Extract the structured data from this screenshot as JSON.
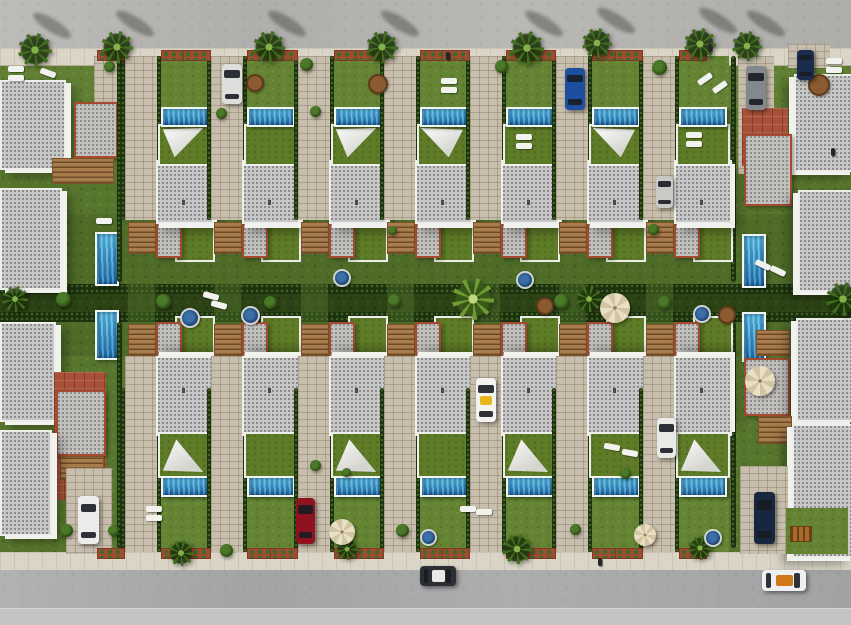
{
  "scene": {
    "kind": "3d-aerial-render",
    "width": 851,
    "height": 625,
    "description": "Top-down aerial 3D render of a residential development: two facing rows of seven detached villas with private pools, white shade sails, gardens and paved driveways, flanked by larger corner buildings, bounded by palm-lined roads at top and bottom with parked cars."
  },
  "palette": {
    "grass": "#57762d",
    "lawn_light": "#648434",
    "alley_green": "#2c4415",
    "hedge": "#1c310e",
    "road": "#b5b4b1",
    "road_bottom": "#a9a9ab",
    "road_bottom_light": "#c4c3c5",
    "sidewalk": "#dad5c6",
    "paver": "#c8bead",
    "terracotta": "#a85138",
    "roof_gray": "#c7c7c7",
    "roof_trim_white": "#ededea",
    "roof_trim_red": "#a34a31",
    "green_roof": "#5e7c27",
    "pool_water": "#2a93cc",
    "pool_coping": "#f0f5f4",
    "sail_white": "#f4f4f1",
    "wood": "#a87c4c",
    "planter_red": "#a04b33",
    "umbrella_beige": "#e0d5b4"
  },
  "layout": {
    "road_top": {
      "x": 0,
      "y": 0,
      "w": 851,
      "h": 48
    },
    "sidewalk_top": {
      "x": 0,
      "y": 48,
      "w": 851,
      "h": 16
    },
    "band_front_top": {
      "x": 0,
      "y": 64,
      "w": 851,
      "h": 44
    },
    "band_back_top": {
      "x": 0,
      "y": 214,
      "w": 851,
      "h": 72
    },
    "alley": {
      "x": 0,
      "y": 286,
      "w": 851,
      "h": 34
    },
    "band_back_bottom": {
      "x": 0,
      "y": 320,
      "w": 851,
      "h": 36
    },
    "sidewalk_bottom": {
      "x": 0,
      "y": 552,
      "w": 851,
      "h": 18
    },
    "road_bottom": {
      "x": 0,
      "y": 570,
      "w": 851,
      "h": 55
    },
    "road_bottom_light": {
      "x": 0,
      "y": 608,
      "w": 851,
      "h": 17
    },
    "alley_hedgerows": [
      284,
      312
    ]
  },
  "villas": {
    "count_top": 7,
    "count_bottom": 7,
    "drive_x": [
      125,
      211,
      298,
      384,
      470,
      556,
      643
    ],
    "content_x": [
      159,
      245,
      332,
      418,
      504,
      590,
      677
    ],
    "content_w": 50,
    "top": {
      "garden_y": 56,
      "garden_h": 52,
      "pool_y": 107,
      "pool_h": 16,
      "terrace_y": 124,
      "terrace_h": 38,
      "roof_y": 160,
      "roof_h": 60,
      "rear_y": 218,
      "drive_y": 56,
      "drive_h": 164,
      "stairs_y": 222
    },
    "bottom": {
      "garden_y": 498,
      "garden_h": 54,
      "pool_y": 476,
      "pool_h": 17,
      "terrace_y": 432,
      "terrace_h": 42,
      "roof_y": 356,
      "roof_h": 76,
      "rear_y": 316,
      "drive_y": 356,
      "drive_h": 196,
      "stairs_y": 324
    },
    "sails_top": [
      true,
      false,
      true,
      true,
      false,
      true,
      false
    ],
    "sails_bottom": [
      true,
      false,
      true,
      false,
      true,
      false,
      true
    ]
  },
  "edges": {
    "left": [
      {
        "t": "paver",
        "x": 94,
        "y": 56,
        "w": 30,
        "h": 56
      },
      {
        "t": "roof",
        "x": 0,
        "y": 80,
        "w": 62,
        "h": 86,
        "wall": "r"
      },
      {
        "t": "redroof",
        "x": 74,
        "y": 102,
        "w": 40,
        "h": 52
      },
      {
        "t": "wood",
        "x": 52,
        "y": 158,
        "w": 60,
        "h": 24
      },
      {
        "t": "roof",
        "x": 0,
        "y": 188,
        "w": 58,
        "h": 98,
        "wall": "r"
      },
      {
        "t": "pool_v",
        "x": 95,
        "y": 232,
        "w": 20,
        "h": 50
      },
      {
        "t": "pool_v",
        "x": 95,
        "y": 310,
        "w": 20,
        "h": 46
      },
      {
        "t": "roof",
        "x": 0,
        "y": 322,
        "w": 52,
        "h": 96,
        "wall": "r"
      },
      {
        "t": "court",
        "x": 54,
        "y": 372,
        "w": 52,
        "h": 128
      },
      {
        "t": "redroof",
        "x": 56,
        "y": 390,
        "w": 46,
        "h": 62
      },
      {
        "t": "wood",
        "x": 60,
        "y": 456,
        "w": 42,
        "h": 22
      },
      {
        "t": "roof",
        "x": 0,
        "y": 430,
        "w": 48,
        "h": 102,
        "wall": "r"
      },
      {
        "t": "paver",
        "x": 66,
        "y": 468,
        "w": 46,
        "h": 86
      },
      {
        "t": "hedge",
        "x": 117,
        "y": 56,
        "w": 5,
        "h": 226
      },
      {
        "t": "hedge",
        "x": 117,
        "y": 322,
        "w": 5,
        "h": 226
      }
    ],
    "right": [
      {
        "t": "paver",
        "x": 738,
        "y": 56,
        "w": 36,
        "h": 118
      },
      {
        "t": "paver",
        "x": 788,
        "y": 44,
        "w": 42,
        "h": 24
      },
      {
        "t": "roof",
        "x": 794,
        "y": 74,
        "w": 57,
        "h": 94,
        "wall": "l"
      },
      {
        "t": "court",
        "x": 742,
        "y": 108,
        "w": 46,
        "h": 58
      },
      {
        "t": "redroof",
        "x": 744,
        "y": 134,
        "w": 44,
        "h": 68
      },
      {
        "t": "roof",
        "x": 798,
        "y": 190,
        "w": 53,
        "h": 98,
        "wall": "l"
      },
      {
        "t": "pool_v",
        "x": 742,
        "y": 234,
        "w": 20,
        "h": 50
      },
      {
        "t": "pool_v",
        "x": 742,
        "y": 312,
        "w": 20,
        "h": 46
      },
      {
        "t": "wood",
        "x": 756,
        "y": 330,
        "w": 32,
        "h": 24
      },
      {
        "t": "redroof",
        "x": 744,
        "y": 358,
        "w": 42,
        "h": 54
      },
      {
        "t": "roof",
        "x": 796,
        "y": 318,
        "w": 55,
        "h": 100,
        "wall": "l"
      },
      {
        "t": "wood",
        "x": 758,
        "y": 416,
        "w": 32,
        "h": 26
      },
      {
        "t": "roof",
        "x": 792,
        "y": 424,
        "w": 59,
        "h": 130,
        "wall": "l"
      },
      {
        "t": "paver",
        "x": 740,
        "y": 466,
        "w": 48,
        "h": 88
      },
      {
        "t": "lawn",
        "x": 786,
        "y": 508,
        "w": 62,
        "h": 46
      },
      {
        "t": "hedge",
        "x": 731,
        "y": 56,
        "w": 5,
        "h": 226
      },
      {
        "t": "hedge",
        "x": 731,
        "y": 322,
        "w": 5,
        "h": 226
      }
    ]
  },
  "decor": [
    {
      "t": "palm",
      "x": 18,
      "y": 33,
      "s": 34,
      "shadow": true
    },
    {
      "t": "palm",
      "x": 101,
      "y": 31,
      "s": 32,
      "shadow": true
    },
    {
      "t": "palm",
      "x": 253,
      "y": 31,
      "s": 32,
      "shadow": true
    },
    {
      "t": "palm",
      "x": 366,
      "y": 31,
      "s": 32,
      "shadow": true
    },
    {
      "t": "palm",
      "x": 510,
      "y": 31,
      "s": 34,
      "shadow": true
    },
    {
      "t": "palm",
      "x": 582,
      "y": 28,
      "s": 30,
      "shadow": true
    },
    {
      "t": "palm",
      "x": 684,
      "y": 28,
      "s": 32,
      "shadow": true
    },
    {
      "t": "palm",
      "x": 732,
      "y": 31,
      "s": 30,
      "shadow": true
    },
    {
      "t": "palm",
      "x": 452,
      "y": 278,
      "s": 42,
      "v": "light"
    },
    {
      "t": "palm",
      "x": 576,
      "y": 286,
      "s": 26
    },
    {
      "t": "palm",
      "x": 826,
      "y": 282,
      "s": 34
    },
    {
      "t": "palm",
      "x": 2,
      "y": 286,
      "s": 26
    },
    {
      "t": "palm",
      "x": 168,
      "y": 540,
      "s": 26
    },
    {
      "t": "palm",
      "x": 336,
      "y": 538,
      "s": 22
    },
    {
      "t": "palm",
      "x": 502,
      "y": 534,
      "s": 30
    },
    {
      "t": "palm",
      "x": 688,
      "y": 536,
      "s": 24
    },
    {
      "t": "bush",
      "x": 300,
      "y": 58,
      "s": 13
    },
    {
      "t": "bush",
      "x": 495,
      "y": 60,
      "s": 13
    },
    {
      "t": "bush",
      "x": 652,
      "y": 60,
      "s": 15
    },
    {
      "t": "bush",
      "x": 104,
      "y": 61,
      "s": 11
    },
    {
      "t": "bush",
      "x": 156,
      "y": 294,
      "s": 15
    },
    {
      "t": "bush",
      "x": 264,
      "y": 296,
      "s": 13
    },
    {
      "t": "bush",
      "x": 388,
      "y": 294,
      "s": 13
    },
    {
      "t": "bush",
      "x": 554,
      "y": 294,
      "s": 15
    },
    {
      "t": "bush",
      "x": 658,
      "y": 296,
      "s": 13
    },
    {
      "t": "bush",
      "x": 56,
      "y": 292,
      "s": 15
    },
    {
      "t": "bush",
      "x": 310,
      "y": 106,
      "s": 11
    },
    {
      "t": "bush",
      "x": 216,
      "y": 108,
      "s": 11
    },
    {
      "t": "bush",
      "x": 648,
      "y": 224,
      "s": 11
    },
    {
      "t": "bush",
      "x": 388,
      "y": 226,
      "s": 9
    },
    {
      "t": "bush",
      "x": 310,
      "y": 460,
      "s": 11
    },
    {
      "t": "bush",
      "x": 396,
      "y": 524,
      "s": 13
    },
    {
      "t": "bush",
      "x": 570,
      "y": 524,
      "s": 11
    },
    {
      "t": "bush",
      "x": 60,
      "y": 524,
      "s": 13
    },
    {
      "t": "bush",
      "x": 620,
      "y": 468,
      "s": 11
    },
    {
      "t": "bush",
      "x": 108,
      "y": 525,
      "s": 11
    },
    {
      "t": "bush",
      "x": 220,
      "y": 544,
      "s": 13
    },
    {
      "t": "bush",
      "x": 342,
      "y": 468,
      "s": 9
    },
    {
      "t": "umbrella",
      "x": 600,
      "y": 293,
      "s": 30
    },
    {
      "t": "umbrella",
      "x": 745,
      "y": 366,
      "s": 30
    },
    {
      "t": "umbrella",
      "x": 329,
      "y": 519,
      "s": 26
    },
    {
      "t": "umbrella",
      "x": 634,
      "y": 524,
      "s": 22
    },
    {
      "t": "jacuzzi",
      "x": 180,
      "y": 308,
      "s": 16
    },
    {
      "t": "jacuzzi",
      "x": 241,
      "y": 306,
      "s": 15
    },
    {
      "t": "jacuzzi",
      "x": 333,
      "y": 269,
      "s": 14
    },
    {
      "t": "jacuzzi",
      "x": 516,
      "y": 271,
      "s": 14
    },
    {
      "t": "jacuzzi",
      "x": 420,
      "y": 529,
      "s": 13
    },
    {
      "t": "jacuzzi",
      "x": 704,
      "y": 529,
      "s": 14
    },
    {
      "t": "jacuzzi",
      "x": 693,
      "y": 305,
      "s": 14
    },
    {
      "t": "lounger",
      "x": 8,
      "y": 66,
      "r": 0
    },
    {
      "t": "lounger",
      "x": 8,
      "y": 75,
      "r": 0
    },
    {
      "t": "lounger",
      "x": 40,
      "y": 70,
      "r": 20
    },
    {
      "t": "lounger",
      "x": 441,
      "y": 78,
      "r": 0
    },
    {
      "t": "lounger",
      "x": 441,
      "y": 87,
      "r": 0
    },
    {
      "t": "lounger",
      "x": 697,
      "y": 76,
      "r": -35
    },
    {
      "t": "lounger",
      "x": 712,
      "y": 84,
      "r": -35
    },
    {
      "t": "lounger",
      "x": 516,
      "y": 134,
      "r": 0
    },
    {
      "t": "lounger",
      "x": 516,
      "y": 143,
      "r": 0
    },
    {
      "t": "lounger",
      "x": 686,
      "y": 132,
      "r": 0
    },
    {
      "t": "lounger",
      "x": 686,
      "y": 141,
      "r": 0
    },
    {
      "t": "lounger",
      "x": 146,
      "y": 506,
      "r": 0
    },
    {
      "t": "lounger",
      "x": 146,
      "y": 515,
      "r": 0
    },
    {
      "t": "lounger",
      "x": 826,
      "y": 58,
      "r": 0
    },
    {
      "t": "lounger",
      "x": 826,
      "y": 67,
      "r": 0
    },
    {
      "t": "lounger",
      "x": 203,
      "y": 293,
      "r": 15
    },
    {
      "t": "lounger",
      "x": 211,
      "y": 302,
      "r": 15
    },
    {
      "t": "lounger",
      "x": 604,
      "y": 444,
      "r": 10
    },
    {
      "t": "lounger",
      "x": 622,
      "y": 450,
      "r": 10
    },
    {
      "t": "lounger",
      "x": 755,
      "y": 262,
      "r": 25
    },
    {
      "t": "lounger",
      "x": 770,
      "y": 268,
      "r": 25
    },
    {
      "t": "lounger",
      "x": 96,
      "y": 218,
      "r": 0
    },
    {
      "t": "lounger",
      "x": 460,
      "y": 506,
      "r": 0
    },
    {
      "t": "lounger",
      "x": 476,
      "y": 509,
      "r": 0
    },
    {
      "t": "tableset",
      "x": 368,
      "y": 74,
      "s": 16
    },
    {
      "t": "tableset",
      "x": 808,
      "y": 74,
      "s": 18
    },
    {
      "t": "tableset",
      "x": 536,
      "y": 297,
      "s": 14
    },
    {
      "t": "tableset",
      "x": 718,
      "y": 306,
      "s": 14
    },
    {
      "t": "tableset",
      "x": 246,
      "y": 74,
      "s": 14
    },
    {
      "t": "person",
      "x": 446,
      "y": 52
    },
    {
      "t": "person",
      "x": 598,
      "y": 558
    },
    {
      "t": "person",
      "x": 708,
      "y": 44
    },
    {
      "t": "person",
      "x": 831,
      "y": 148
    },
    {
      "t": "swing",
      "x": 790,
      "y": 526,
      "w": 20,
      "h": 14
    }
  ],
  "cars": [
    {
      "name": "white-suv-top",
      "x": 222,
      "y": 64,
      "w": 20,
      "h": 40,
      "o": "v",
      "color": "#dededc"
    },
    {
      "name": "blue-car-top",
      "x": 565,
      "y": 68,
      "w": 20,
      "h": 42,
      "o": "v",
      "color": "#1d4f9e"
    },
    {
      "name": "gray-car-top-right",
      "x": 746,
      "y": 66,
      "w": 20,
      "h": 44,
      "o": "v",
      "color": "#83888f"
    },
    {
      "name": "navy-car-top-right",
      "x": 797,
      "y": 50,
      "w": 17,
      "h": 30,
      "o": "v",
      "color": "#1c2c4e"
    },
    {
      "name": "gray-van-mid-right",
      "x": 656,
      "y": 176,
      "w": 17,
      "h": 32,
      "o": "v",
      "color": "#c9c9c6"
    },
    {
      "name": "taxi-driveway",
      "x": 476,
      "y": 378,
      "w": 20,
      "h": 44,
      "o": "v",
      "color": "#f2f2ef",
      "accent": "#e8b51e"
    },
    {
      "name": "white-van-bottom-right",
      "x": 657,
      "y": 418,
      "w": 19,
      "h": 40,
      "o": "v",
      "color": "#e9e9e6"
    },
    {
      "name": "red-car-bottom",
      "x": 296,
      "y": 498,
      "w": 19,
      "h": 46,
      "o": "v",
      "color": "#8e1220"
    },
    {
      "name": "white-sports-car-bottom-left",
      "x": 78,
      "y": 496,
      "w": 21,
      "h": 48,
      "o": "v",
      "color": "#ececea"
    },
    {
      "name": "navy-car-bottom-right",
      "x": 754,
      "y": 492,
      "w": 21,
      "h": 52,
      "o": "v",
      "color": "#182740"
    },
    {
      "name": "suv-on-road",
      "x": 420,
      "y": 566,
      "w": 36,
      "h": 20,
      "o": "h",
      "color": "#2b2e33",
      "accent": "#e8e8e6"
    },
    {
      "name": "convertible-on-road",
      "x": 762,
      "y": 570,
      "w": 44,
      "h": 21,
      "o": "h",
      "color": "#eef0f1",
      "accent": "#d07818"
    }
  ]
}
